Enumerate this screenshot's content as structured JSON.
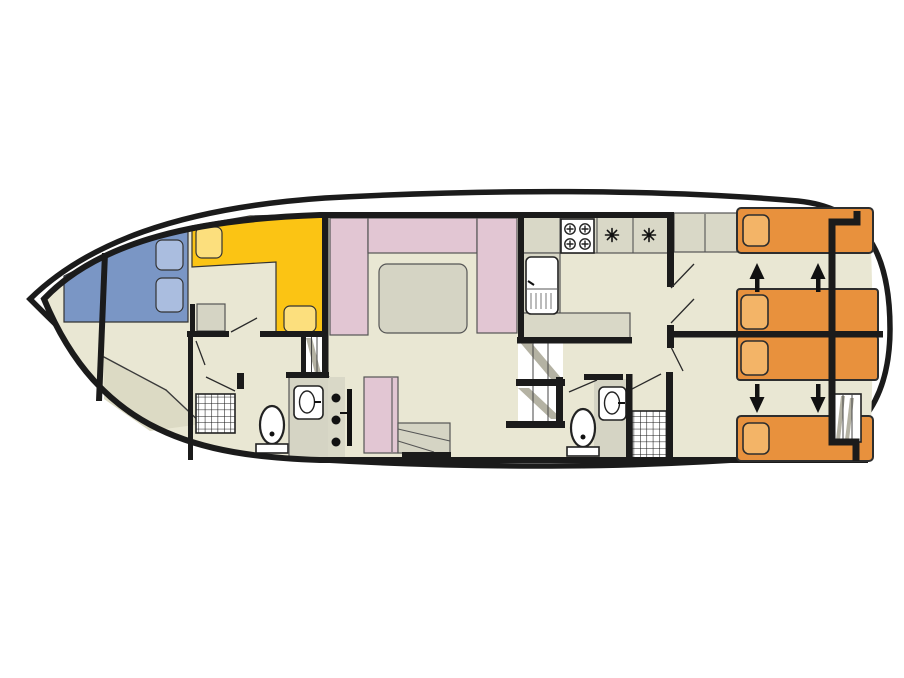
{
  "diagram": {
    "type": "boat-floorplan",
    "title": "Houseboat deck plan (top view)",
    "orientation": "bow-left-stern-right",
    "rooms": [
      {
        "name": "bow-cabin",
        "label": "Forward cabin with double berth"
      },
      {
        "name": "helm-dinette",
        "label": "Helm seat / L-shaped bench"
      },
      {
        "name": "forward-bathroom",
        "label": "Forward bathroom with shower and toilet"
      },
      {
        "name": "washroom",
        "label": "Washbasin room"
      },
      {
        "name": "saloon",
        "label": "Saloon with U-shaped sofa and table"
      },
      {
        "name": "mid-cabin",
        "label": "Middle cabin with single berth"
      },
      {
        "name": "galley",
        "label": "Galley with stove, sink and fridges"
      },
      {
        "name": "aft-bathroom",
        "label": "Aft bathroom with shower, basin and toilet"
      },
      {
        "name": "stern-cabin-upper",
        "label": "Aft cabin (port) with single and double berth"
      },
      {
        "name": "stern-cabin-lower",
        "label": "Aft cabin (starboard) with single and double berth"
      }
    ],
    "fixtures": {
      "berths": 7,
      "stove_burners": 4,
      "fridge_symbols": 2,
      "sinks": 1,
      "washbasins": 2,
      "toilets": 2,
      "showers": 2,
      "staircases": 3,
      "convertible_bed_arrows": 4
    }
  },
  "colors": {
    "page_bg": "#ffffff",
    "hull": "#1b1b1b",
    "deck": "#ffffff",
    "floor": "#e9e7d3",
    "floor_shade": "#dcdac4",
    "wall": "#1b1b1b",
    "blue_bed": "#7a96c5",
    "blue_cushion": "#aabddf",
    "yellow_bench": "#fbc414",
    "yellow_cushion": "#fcdf7d",
    "pink": "#e2c6d3",
    "gray_furniture": "#d5d4c4",
    "counter": "#d9d8c7",
    "orange_bed": "#e8913d",
    "orange_pillow": "#f3b467",
    "fixture_white": "#ffffff",
    "stair_shade": "#b4b2a3",
    "symbol": "#111111"
  }
}
